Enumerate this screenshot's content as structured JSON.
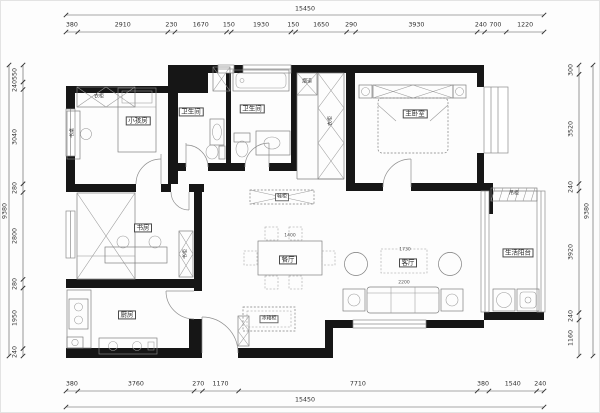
{
  "plan": {
    "type": "apartment-floor-plan",
    "title_labels": {
      "room_kids": "小孩房",
      "room_bath1": "卫生间",
      "room_bath2": "卫生间",
      "room_master": "主卧室",
      "room_study": "书房",
      "room_dining": "餐厅",
      "room_living": "客厅",
      "room_kitchen": "厨房",
      "room_balcony": "生活阳台"
    },
    "furniture_labels": {
      "wardrobe_kids": "衣柜",
      "desk_kids": "书桌",
      "bookcase_study": "书柜",
      "wardrobe_master": "衣柜",
      "flue": "烟道",
      "hanging_cabinet": "吊柜",
      "shoe_cabinet": "鞋柜",
      "fridge_cabinet": "冰箱柜"
    },
    "furniture_dims": {
      "dining_table": "1400",
      "living_width": "1730",
      "sofa": "2200"
    },
    "dimensions": {
      "top": {
        "segments": [
          380,
          2910,
          230,
          1670,
          150,
          1930,
          150,
          1650,
          290,
          3930,
          240,
          700,
          1220
        ],
        "total": "15450"
      },
      "bottom": {
        "segments": [
          380,
          3760,
          270,
          1170,
          7710,
          380,
          1540,
          240
        ],
        "total": "15450"
      },
      "left": {
        "segments": [
          550,
          240,
          3040,
          280,
          2800,
          280,
          1950,
          240
        ],
        "total": "9380"
      },
      "right": {
        "segments": [
          300,
          3520,
          240,
          3920,
          240,
          1160
        ],
        "total": "9380"
      }
    },
    "colors": {
      "wall": "#161616",
      "line": "#7f7f7f",
      "dim_text": "#2f2f2f",
      "background": "#fdfdfd"
    }
  }
}
